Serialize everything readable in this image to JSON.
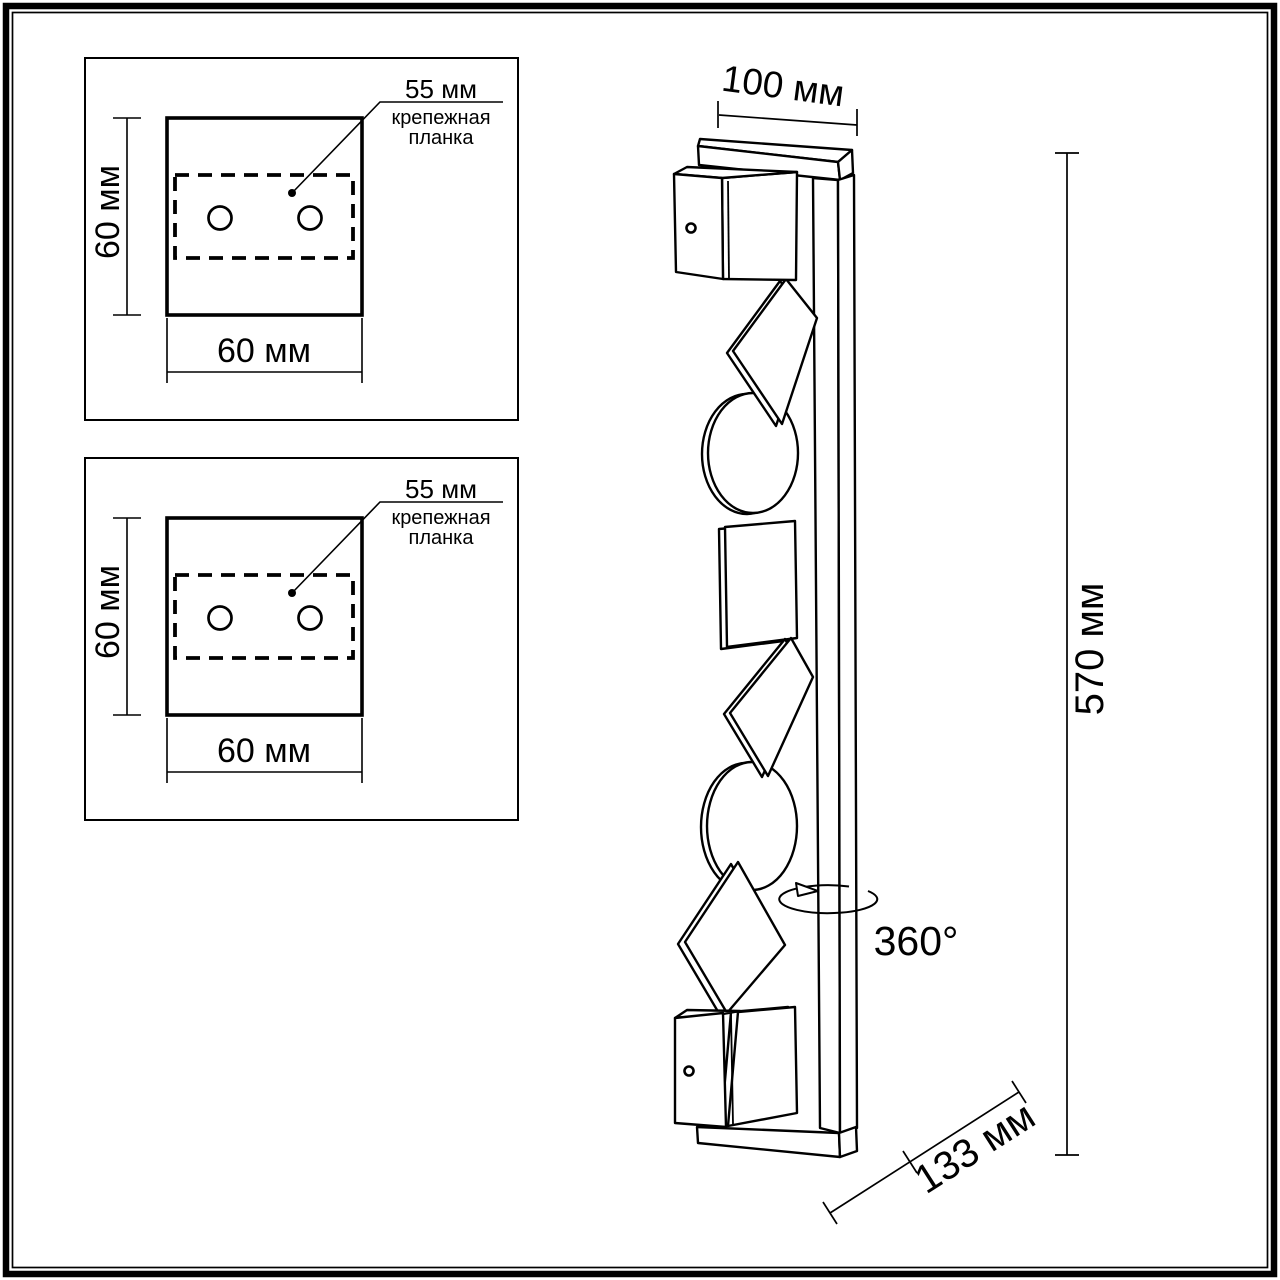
{
  "colors": {
    "line": "#000000",
    "background": "#ffffff"
  },
  "mount_panels": [
    {
      "plate_width": "55 мм",
      "plate_label_line1": "крепежная",
      "plate_label_line2": "планка",
      "height": "60 мм",
      "width": "60 мм"
    },
    {
      "plate_width": "55 мм",
      "plate_label_line1": "крепежная",
      "plate_label_line2": "планка",
      "height": "60 мм",
      "width": "60 мм"
    }
  ],
  "side_view": {
    "top_width": "100 мм",
    "height": "570 мм",
    "bottom_depth": "133 мм",
    "rotation_angle": "360°"
  }
}
